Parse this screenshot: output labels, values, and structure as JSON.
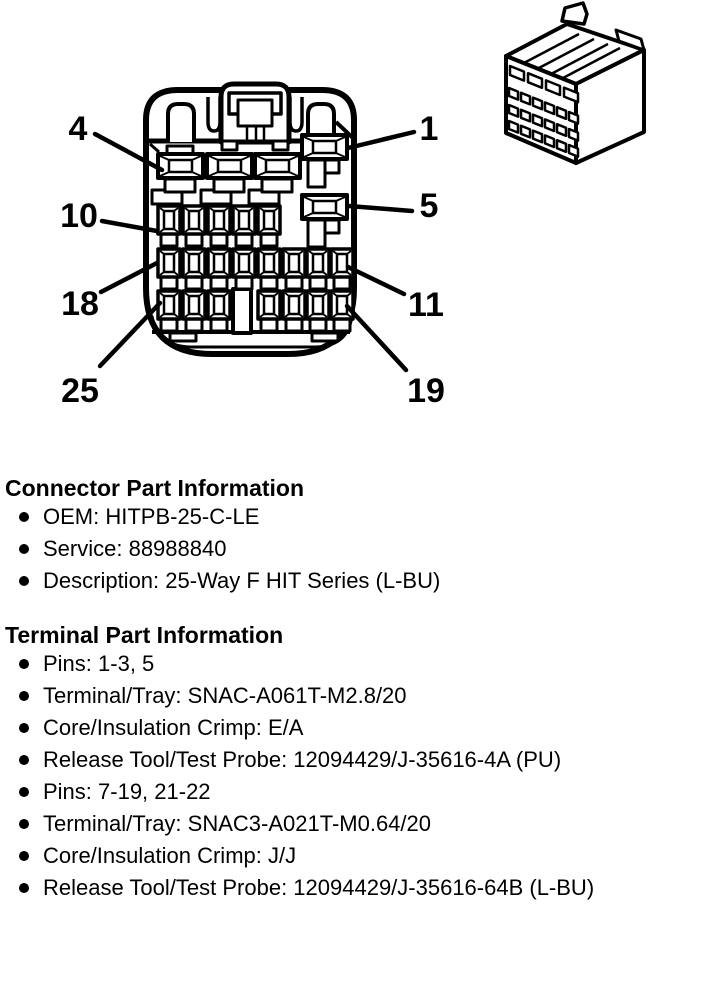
{
  "figure": {
    "ink_color": "#000000",
    "callouts": [
      {
        "label": "4",
        "label_x": 78,
        "label_y": 140,
        "line": [
          95,
          134,
          162,
          170
        ]
      },
      {
        "label": "1",
        "label_x": 429,
        "label_y": 140,
        "line": [
          414,
          132,
          348,
          148
        ]
      },
      {
        "label": "10",
        "label_x": 79,
        "label_y": 227,
        "line": [
          102,
          221,
          157,
          231
        ]
      },
      {
        "label": "5",
        "label_x": 429,
        "label_y": 217,
        "line": [
          412,
          211,
          349,
          206
        ]
      },
      {
        "label": "18",
        "label_x": 80,
        "label_y": 315,
        "line": [
          101,
          292,
          157,
          263
        ]
      },
      {
        "label": "11",
        "label_x": 426,
        "label_y": 316,
        "line": [
          404,
          294,
          348,
          267
        ]
      },
      {
        "label": "25",
        "label_x": 80,
        "label_y": 402,
        "line": [
          100,
          366,
          160,
          303
        ]
      },
      {
        "label": "19",
        "label_x": 426,
        "label_y": 402,
        "line": [
          406,
          370,
          347,
          306
        ]
      }
    ],
    "large_cavities": [
      {
        "x": 158,
        "y": 154,
        "bracket": "left"
      },
      {
        "x": 207,
        "y": 154,
        "bracket": "left"
      },
      {
        "x": 255,
        "y": 154,
        "bracket": "left"
      },
      {
        "x": 302,
        "y": 135,
        "bracket": "inset"
      },
      {
        "x": 302,
        "y": 195,
        "bracket": "inset"
      }
    ],
    "small_cavity_rows": [
      {
        "y": 206,
        "xs": [
          158,
          183,
          208,
          233,
          258
        ]
      },
      {
        "y": 249,
        "xs": [
          158,
          183,
          208,
          233,
          258,
          283,
          307,
          331
        ]
      },
      {
        "y": 291,
        "xs": [
          158,
          183,
          208,
          258,
          283,
          307,
          331
        ]
      }
    ],
    "iso_grid_rows": [
      {
        "x": 510,
        "y": 66,
        "n": 4,
        "w": 14,
        "h": 9,
        "adv": 18
      },
      {
        "x": 509,
        "y": 88,
        "n": 6,
        "w": 9,
        "h": 8,
        "adv": 12
      },
      {
        "x": 509,
        "y": 105,
        "n": 6,
        "w": 9,
        "h": 8,
        "adv": 12
      },
      {
        "x": 509,
        "y": 121,
        "n": 6,
        "w": 9,
        "h": 8,
        "adv": 12
      }
    ]
  },
  "connector_section": {
    "heading": "Connector Part Information",
    "items": [
      "OEM: HITPB-25-C-LE",
      "Service: 88988840",
      "Description: 25-Way F HIT Series (L-BU)"
    ]
  },
  "terminal_section": {
    "heading": "Terminal Part Information",
    "groups": [
      {
        "items": [
          "Pins: 1-3, 5",
          "Terminal/Tray: SNAC-A061T-M2.8/20",
          "Core/Insulation Crimp: E/A",
          "Release Tool/Test Probe: 12094429/J-35616-4A (PU)"
        ]
      },
      {
        "items": [
          "Pins: 7-19, 21-22",
          "Terminal/Tray: SNAC3-A021T-M0.64/20",
          "Core/Insulation Crimp: J/J",
          "Release Tool/Test Probe: 12094429/J-35616-64B (L-BU)"
        ]
      }
    ]
  }
}
